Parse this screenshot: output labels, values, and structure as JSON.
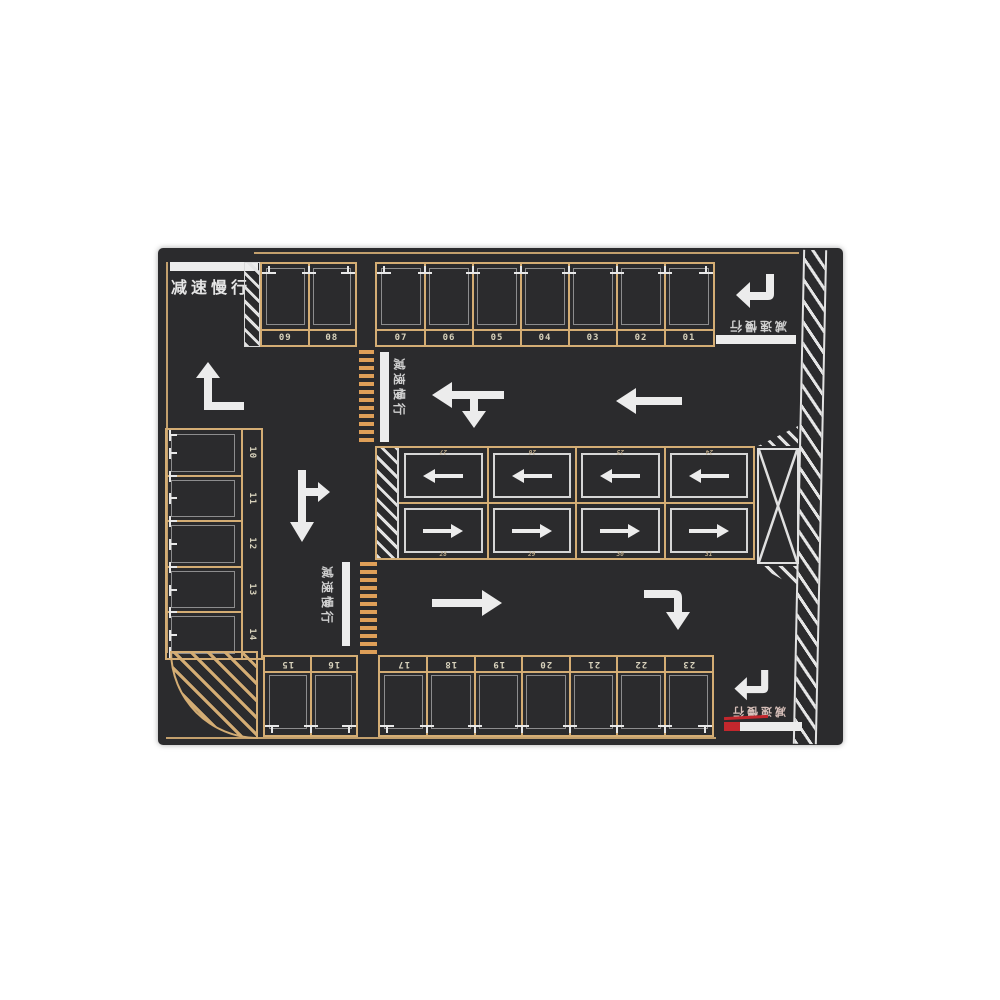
{
  "scene": "parking-lot-marking-plan",
  "colors": {
    "background": "#ffffff",
    "asphalt": "#2b2b2d",
    "stall_line_tan": "#d4ad74",
    "crosswalk_orange": "#de9f58",
    "marking_white": "#ececec",
    "stop_bar_red": "#c2272d"
  },
  "labels": {
    "slow_down": "减速慢行"
  },
  "stall_blocks": {
    "top_left": [
      "09",
      "08"
    ],
    "top_main": [
      "07",
      "06",
      "05",
      "04",
      "03",
      "02",
      "01"
    ],
    "left_column": [
      "10",
      "11",
      "12",
      "13",
      "14"
    ],
    "bottom_left": [
      "15",
      "16"
    ],
    "bottom_main": [
      "17",
      "18",
      "19",
      "20",
      "21",
      "22",
      "23"
    ],
    "middle_upper": [
      "27",
      "26",
      "25",
      "24"
    ],
    "middle_lower": [
      "28",
      "29",
      "30",
      "31"
    ]
  },
  "icons": {
    "left-turn-ahead-arrow": "lane arrow up then left",
    "down-right-branch-arrow": "lane arrow down with right branch",
    "left-with-down-branch-arrow": "lane arrow left with down branch",
    "left-arrow": "lane arrow straight left",
    "right-arrow": "lane arrow straight right",
    "right-then-down-arrow": "lane arrow right then down",
    "entry-turn-arrow-top": "entry arrow down then left",
    "entry-turn-arrow-bottom": "entry arrow down then left",
    "no-parking-cross-box": "X crossed no-parking box",
    "zebra-crosswalk-upper": "pedestrian crossing bars",
    "zebra-crosswalk-lower": "pedestrian crossing bars",
    "corner-hatch-island": "quarter-circle hatched island",
    "edge-hatch-strip": "boundary hatched strip"
  }
}
